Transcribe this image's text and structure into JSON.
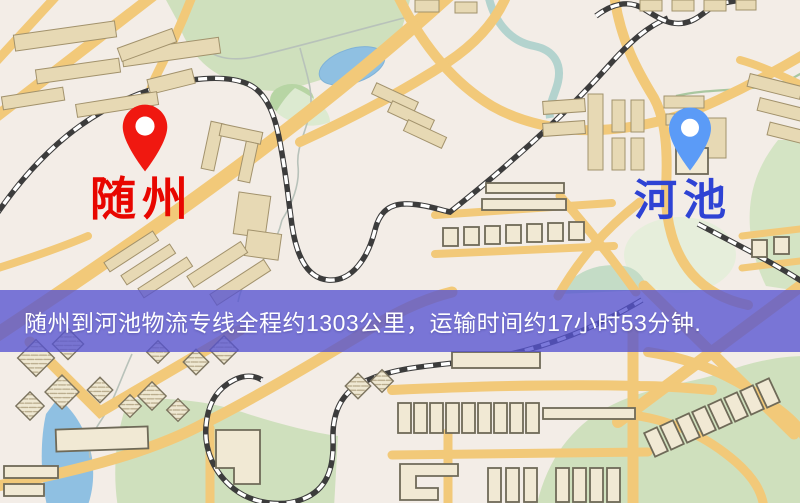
{
  "map": {
    "origin": {
      "name": "随州",
      "label_color": "#E80600",
      "pin_color": "#F01810"
    },
    "destination": {
      "name": "河池",
      "label_color": "#2E43D4",
      "pin_color": "#5B9BF7"
    },
    "banner": {
      "text": "随州到河池物流专线全程约1303公里，运输时间约17小时53分钟.",
      "overlay_color": "#5653D1",
      "text_color": "#FFFFFF"
    },
    "route": {
      "distance_text": "约1303公里",
      "duration_text": "约17小时53分钟"
    }
  }
}
